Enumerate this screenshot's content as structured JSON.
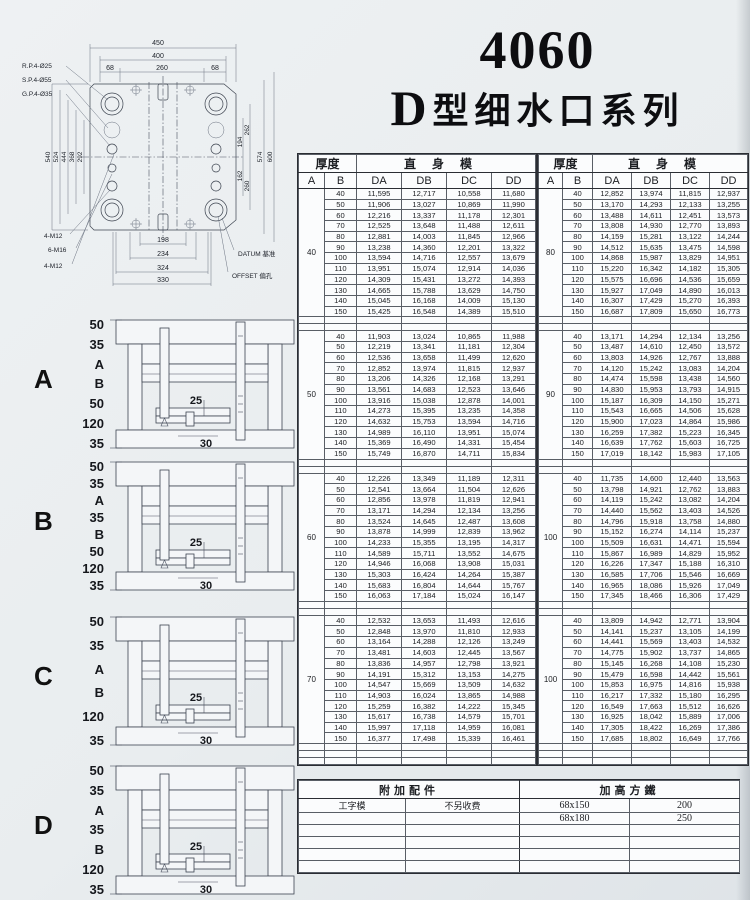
{
  "title": {
    "number": "4060",
    "series_prefix": "D",
    "series": "型细水口系列"
  },
  "drawing": {
    "leader_rp": "R.P.4-Ø25",
    "leader_sp": "S.P.4-Ø55",
    "leader_gp": "G.P.4-Ø35",
    "m12a": "4-M12",
    "m16": "6-M16",
    "m12b": "4-M12",
    "datum": "DATUM 基准",
    "offset": "OFFSET 偏孔",
    "dims": {
      "top": [
        "450",
        "400",
        "68",
        "260",
        "68"
      ],
      "left": [
        "540",
        "524",
        "444",
        "368",
        "292"
      ],
      "right": [
        "262",
        "194",
        "162",
        "260",
        "574",
        "600"
      ],
      "bottom": [
        "198",
        "234",
        "324",
        "330"
      ]
    }
  },
  "diagrams": [
    {
      "letter": "A",
      "dims": [
        "50",
        "35",
        "A",
        "B",
        "50",
        "120",
        "35"
      ],
      "inner": [
        "25",
        "30"
      ]
    },
    {
      "letter": "B",
      "dims": [
        "50",
        "35",
        "A",
        "35",
        "B",
        "50",
        "120",
        "35"
      ],
      "inner": [
        "25",
        "30"
      ]
    },
    {
      "letter": "C",
      "dims": [
        "50",
        "35",
        "A",
        "B",
        "120",
        "35"
      ],
      "inner": [
        "25",
        "30"
      ]
    },
    {
      "letter": "D",
      "dims": [
        "50",
        "35",
        "A",
        "35",
        "B",
        "120",
        "35"
      ],
      "inner": [
        "25",
        "30"
      ]
    }
  ],
  "tables": {
    "header": {
      "thickness": "厚度",
      "straight": "直身模",
      "a": "A",
      "b": "B",
      "cols": [
        "DA",
        "DB",
        "DC",
        "DD"
      ]
    },
    "left": {
      "sections": [
        {
          "a": "40",
          "rows": [
            [
              "40",
              "11,595",
              "12,717",
              "10,558",
              "11,680"
            ],
            [
              "50",
              "11,906",
              "13,027",
              "10,869",
              "11,990"
            ],
            [
              "60",
              "12,216",
              "13,337",
              "11,178",
              "12,301"
            ],
            [
              "70",
              "12,525",
              "13,648",
              "11,488",
              "12,611"
            ],
            [
              "80",
              "12,881",
              "14,003",
              "11,845",
              "12,966"
            ],
            [
              "90",
              "13,238",
              "14,360",
              "12,201",
              "13,322"
            ],
            [
              "100",
              "13,594",
              "14,716",
              "12,557",
              "13,679"
            ],
            [
              "110",
              "13,951",
              "15,074",
              "12,914",
              "14,036"
            ],
            [
              "120",
              "14,309",
              "15,431",
              "13,272",
              "14,393"
            ],
            [
              "130",
              "14,665",
              "15,788",
              "13,629",
              "14,750"
            ],
            [
              "140",
              "15,045",
              "16,168",
              "14,009",
              "15,130"
            ],
            [
              "150",
              "15,425",
              "16,548",
              "14,389",
              "15,510"
            ]
          ]
        },
        {
          "a": "50",
          "rows": [
            [
              "40",
              "11,903",
              "13,024",
              "10,865",
              "11,988"
            ],
            [
              "50",
              "12,219",
              "13,341",
              "11,181",
              "12,304"
            ],
            [
              "60",
              "12,536",
              "13,658",
              "11,499",
              "12,620"
            ],
            [
              "70",
              "12,852",
              "13,974",
              "11,815",
              "12,937"
            ],
            [
              "80",
              "13,206",
              "14,326",
              "12,168",
              "13,291"
            ],
            [
              "90",
              "13,561",
              "14,683",
              "12,523",
              "13,646"
            ],
            [
              "100",
              "13,916",
              "15,038",
              "12,878",
              "14,001"
            ],
            [
              "110",
              "14,273",
              "15,395",
              "13,235",
              "14,358"
            ],
            [
              "120",
              "14,632",
              "15,753",
              "13,594",
              "14,716"
            ],
            [
              "130",
              "14,989",
              "16,110",
              "13,951",
              "15,074"
            ],
            [
              "140",
              "15,369",
              "16,490",
              "14,331",
              "15,454"
            ],
            [
              "150",
              "15,749",
              "16,870",
              "14,711",
              "15,834"
            ]
          ]
        },
        {
          "a": "60",
          "rows": [
            [
              "40",
              "12,226",
              "13,349",
              "11,189",
              "12,311"
            ],
            [
              "50",
              "12,541",
              "13,664",
              "11,504",
              "12,626"
            ],
            [
              "60",
              "12,856",
              "13,978",
              "11,819",
              "12,941"
            ],
            [
              "70",
              "13,171",
              "14,294",
              "12,134",
              "13,256"
            ],
            [
              "80",
              "13,524",
              "14,645",
              "12,487",
              "13,608"
            ],
            [
              "90",
              "13,878",
              "14,999",
              "12,839",
              "13,962"
            ],
            [
              "100",
              "14,233",
              "15,355",
              "13,195",
              "14,317"
            ],
            [
              "110",
              "14,589",
              "15,711",
              "13,552",
              "14,675"
            ],
            [
              "120",
              "14,946",
              "16,068",
              "13,908",
              "15,031"
            ],
            [
              "130",
              "15,303",
              "16,424",
              "14,264",
              "15,387"
            ],
            [
              "140",
              "15,683",
              "16,804",
              "14,644",
              "15,767"
            ],
            [
              "150",
              "16,063",
              "17,184",
              "15,024",
              "16,147"
            ]
          ]
        },
        {
          "a": "70",
          "rows": [
            [
              "40",
              "12,532",
              "13,653",
              "11,493",
              "12,616"
            ],
            [
              "50",
              "12,848",
              "13,970",
              "11,810",
              "12,933"
            ],
            [
              "60",
              "13,164",
              "14,288",
              "12,126",
              "13,249"
            ],
            [
              "70",
              "13,481",
              "14,603",
              "12,445",
              "13,567"
            ],
            [
              "80",
              "13,836",
              "14,957",
              "12,798",
              "13,921"
            ],
            [
              "90",
              "14,191",
              "15,312",
              "13,153",
              "14,275"
            ],
            [
              "100",
              "14,547",
              "15,669",
              "13,509",
              "14,632"
            ],
            [
              "110",
              "14,903",
              "16,024",
              "13,865",
              "14,988"
            ],
            [
              "120",
              "15,259",
              "16,382",
              "14,222",
              "15,345"
            ],
            [
              "130",
              "15,617",
              "16,738",
              "14,579",
              "15,701"
            ],
            [
              "140",
              "15,997",
              "17,118",
              "14,959",
              "16,081"
            ],
            [
              "150",
              "16,377",
              "17,498",
              "15,339",
              "16,461"
            ]
          ]
        }
      ]
    },
    "right": {
      "sections": [
        {
          "a": "80",
          "rows": [
            [
              "40",
              "12,852",
              "13,974",
              "11,815",
              "12,937"
            ],
            [
              "50",
              "13,170",
              "14,293",
              "12,133",
              "13,255"
            ],
            [
              "60",
              "13,488",
              "14,611",
              "12,451",
              "13,573"
            ],
            [
              "70",
              "13,808",
              "14,930",
              "12,770",
              "13,893"
            ],
            [
              "80",
              "14,159",
              "15,281",
              "13,122",
              "14,244"
            ],
            [
              "90",
              "14,512",
              "15,635",
              "13,475",
              "14,598"
            ],
            [
              "100",
              "14,868",
              "15,987",
              "13,829",
              "14,951"
            ],
            [
              "110",
              "15,220",
              "16,342",
              "14,182",
              "15,305"
            ],
            [
              "120",
              "15,575",
              "16,696",
              "14,536",
              "15,659"
            ],
            [
              "130",
              "15,927",
              "17,049",
              "14,890",
              "16,013"
            ],
            [
              "140",
              "16,307",
              "17,429",
              "15,270",
              "16,393"
            ],
            [
              "150",
              "16,687",
              "17,809",
              "15,650",
              "16,773"
            ]
          ]
        },
        {
          "a": "90",
          "rows": [
            [
              "40",
              "13,171",
              "14,294",
              "12,134",
              "13,256"
            ],
            [
              "50",
              "13,487",
              "14,610",
              "12,450",
              "13,572"
            ],
            [
              "60",
              "13,803",
              "14,926",
              "12,767",
              "13,888"
            ],
            [
              "70",
              "14,120",
              "15,242",
              "13,083",
              "14,204"
            ],
            [
              "80",
              "14,474",
              "15,598",
              "13,438",
              "14,560"
            ],
            [
              "90",
              "14,830",
              "15,953",
              "13,793",
              "14,915"
            ],
            [
              "100",
              "15,187",
              "16,309",
              "14,150",
              "15,271"
            ],
            [
              "110",
              "15,543",
              "16,665",
              "14,506",
              "15,628"
            ],
            [
              "120",
              "15,900",
              "17,023",
              "14,864",
              "15,986"
            ],
            [
              "130",
              "16,259",
              "17,382",
              "15,223",
              "16,345"
            ],
            [
              "140",
              "16,639",
              "17,762",
              "15,603",
              "16,725"
            ],
            [
              "150",
              "17,019",
              "18,142",
              "15,983",
              "17,105"
            ]
          ]
        },
        {
          "a": "100",
          "rows": [
            [
              "40",
              "11,735",
              "14,600",
              "12,440",
              "13,563"
            ],
            [
              "50",
              "13,798",
              "14,921",
              "12,762",
              "13,883"
            ],
            [
              "60",
              "14,119",
              "15,242",
              "13,082",
              "14,204"
            ],
            [
              "70",
              "14,440",
              "15,562",
              "13,403",
              "14,526"
            ],
            [
              "80",
              "14,796",
              "15,918",
              "13,758",
              "14,880"
            ],
            [
              "90",
              "15,152",
              "16,274",
              "14,114",
              "15,237"
            ],
            [
              "100",
              "15,509",
              "16,631",
              "14,471",
              "15,594"
            ],
            [
              "110",
              "15,867",
              "16,989",
              "14,829",
              "15,952"
            ],
            [
              "120",
              "16,226",
              "17,347",
              "15,188",
              "16,310"
            ],
            [
              "130",
              "16,585",
              "17,706",
              "15,546",
              "16,669"
            ],
            [
              "140",
              "16,965",
              "18,086",
              "15,926",
              "17,049"
            ],
            [
              "150",
              "17,345",
              "18,466",
              "16,306",
              "17,429"
            ]
          ]
        },
        {
          "a": "100",
          "rows": [
            [
              "40",
              "13,809",
              "14,942",
              "12,771",
              "13,904"
            ],
            [
              "50",
              "14,141",
              "15,237",
              "13,105",
              "14,199"
            ],
            [
              "60",
              "14,441",
              "15,569",
              "13,403",
              "14,532"
            ],
            [
              "70",
              "14,775",
              "15,902",
              "13,737",
              "14,865"
            ],
            [
              "80",
              "15,145",
              "16,268",
              "14,108",
              "15,230"
            ],
            [
              "90",
              "15,479",
              "16,598",
              "14,442",
              "15,561"
            ],
            [
              "100",
              "15,853",
              "16,975",
              "14,816",
              "15,938"
            ],
            [
              "110",
              "16,217",
              "17,332",
              "15,180",
              "16,295"
            ],
            [
              "120",
              "16,549",
              "17,663",
              "15,512",
              "16,626"
            ],
            [
              "130",
              "16,925",
              "18,042",
              "15,889",
              "17,006"
            ],
            [
              "140",
              "17,305",
              "18,422",
              "16,269",
              "17,386"
            ],
            [
              "150",
              "17,685",
              "18,802",
              "16,649",
              "17,766"
            ]
          ]
        }
      ]
    }
  },
  "bottom_table": {
    "header_left": "附加配件",
    "header_right": "加高方鐵",
    "rows": [
      [
        "工字模",
        "不另收费",
        "68x150",
        "200"
      ],
      [
        "",
        "",
        "68x180",
        "250"
      ],
      [
        "",
        "",
        "",
        ""
      ],
      [
        "",
        "",
        "",
        ""
      ],
      [
        "",
        "",
        "",
        ""
      ],
      [
        "",
        "",
        "",
        ""
      ]
    ]
  }
}
